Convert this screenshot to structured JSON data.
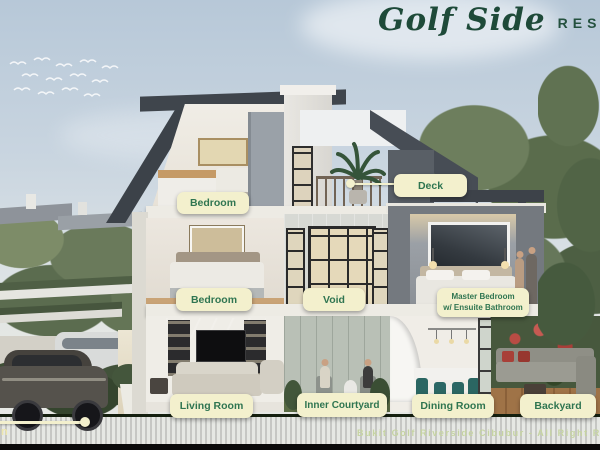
{
  "header": {
    "brand_script": "Golf Side",
    "brand_caps": "RESIDENCE"
  },
  "annotations": {
    "deck": {
      "label": "Deck"
    },
    "bedroom_upper": {
      "label": "Bedroom"
    },
    "bedroom_middle": {
      "label": "Bedroom"
    },
    "void": {
      "label": "Void"
    },
    "master_bedroom": {
      "line1": "Master Bedroom",
      "line2": "w/ Ensuite Bathroom"
    },
    "living_room": {
      "label": "Living Room"
    },
    "inner_courtyard": {
      "label": "Inner Courtyard"
    },
    "dining_room": {
      "label": "Dining Room"
    },
    "backyard": {
      "label": "Backyard"
    },
    "clipped_left_label_fragment": "n"
  },
  "footer": {
    "credit": "Bukit Golf Riverside Cibubur - All Right Reserved"
  },
  "colors": {
    "label_bg": "#f3f0cd",
    "label_text": "#2f7551",
    "brand_green": "#1e4a39",
    "footer_text": "#c6d4a2",
    "sky_top": "#b7c8d8",
    "grass_band": "#243118",
    "roof_dark": "#3f454c",
    "teal_chair": "#2b6662"
  }
}
